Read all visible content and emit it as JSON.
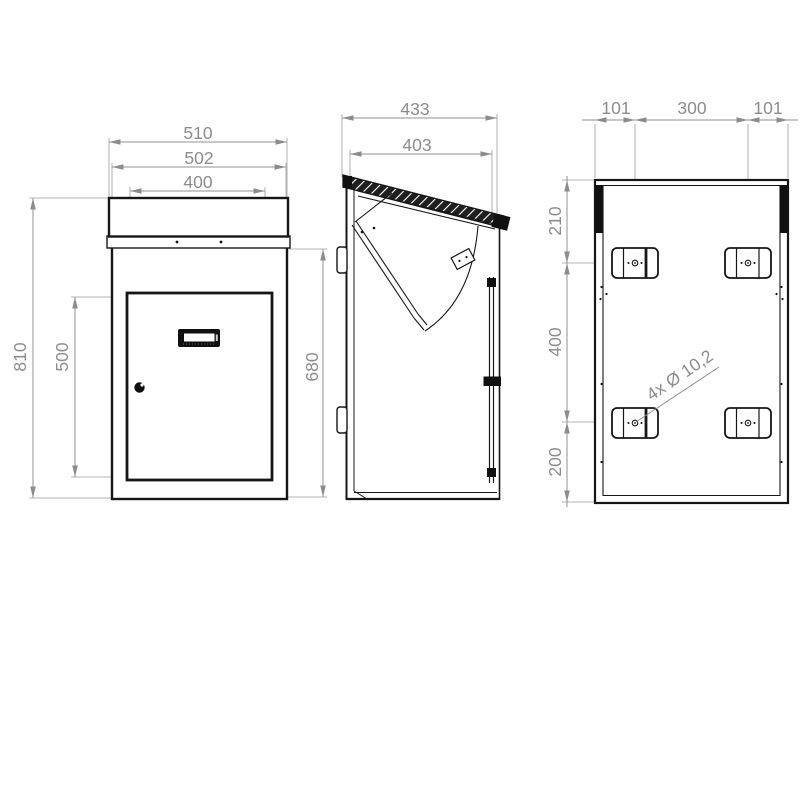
{
  "drawing": {
    "background": "#ffffff",
    "line_color": "#161616",
    "dim_color": "#8c8c8c"
  },
  "front_view": {
    "dim_total_width": "510",
    "dim_body_width": "502",
    "dim_slot_width": "400",
    "dim_total_height": "810",
    "dim_door_height": "500",
    "dim_body_height": "680"
  },
  "side_view": {
    "dim_total_depth": "433",
    "dim_body_depth": "403"
  },
  "back_view": {
    "dim_hole_offset_left": "101",
    "dim_hole_spacing": "300",
    "dim_hole_offset_right": "101",
    "dim_top_to_holes": "210",
    "dim_holes_vertical_spacing": "400",
    "dim_holes_to_bottom": "200",
    "hole_note": "4x Ø 10,2"
  }
}
